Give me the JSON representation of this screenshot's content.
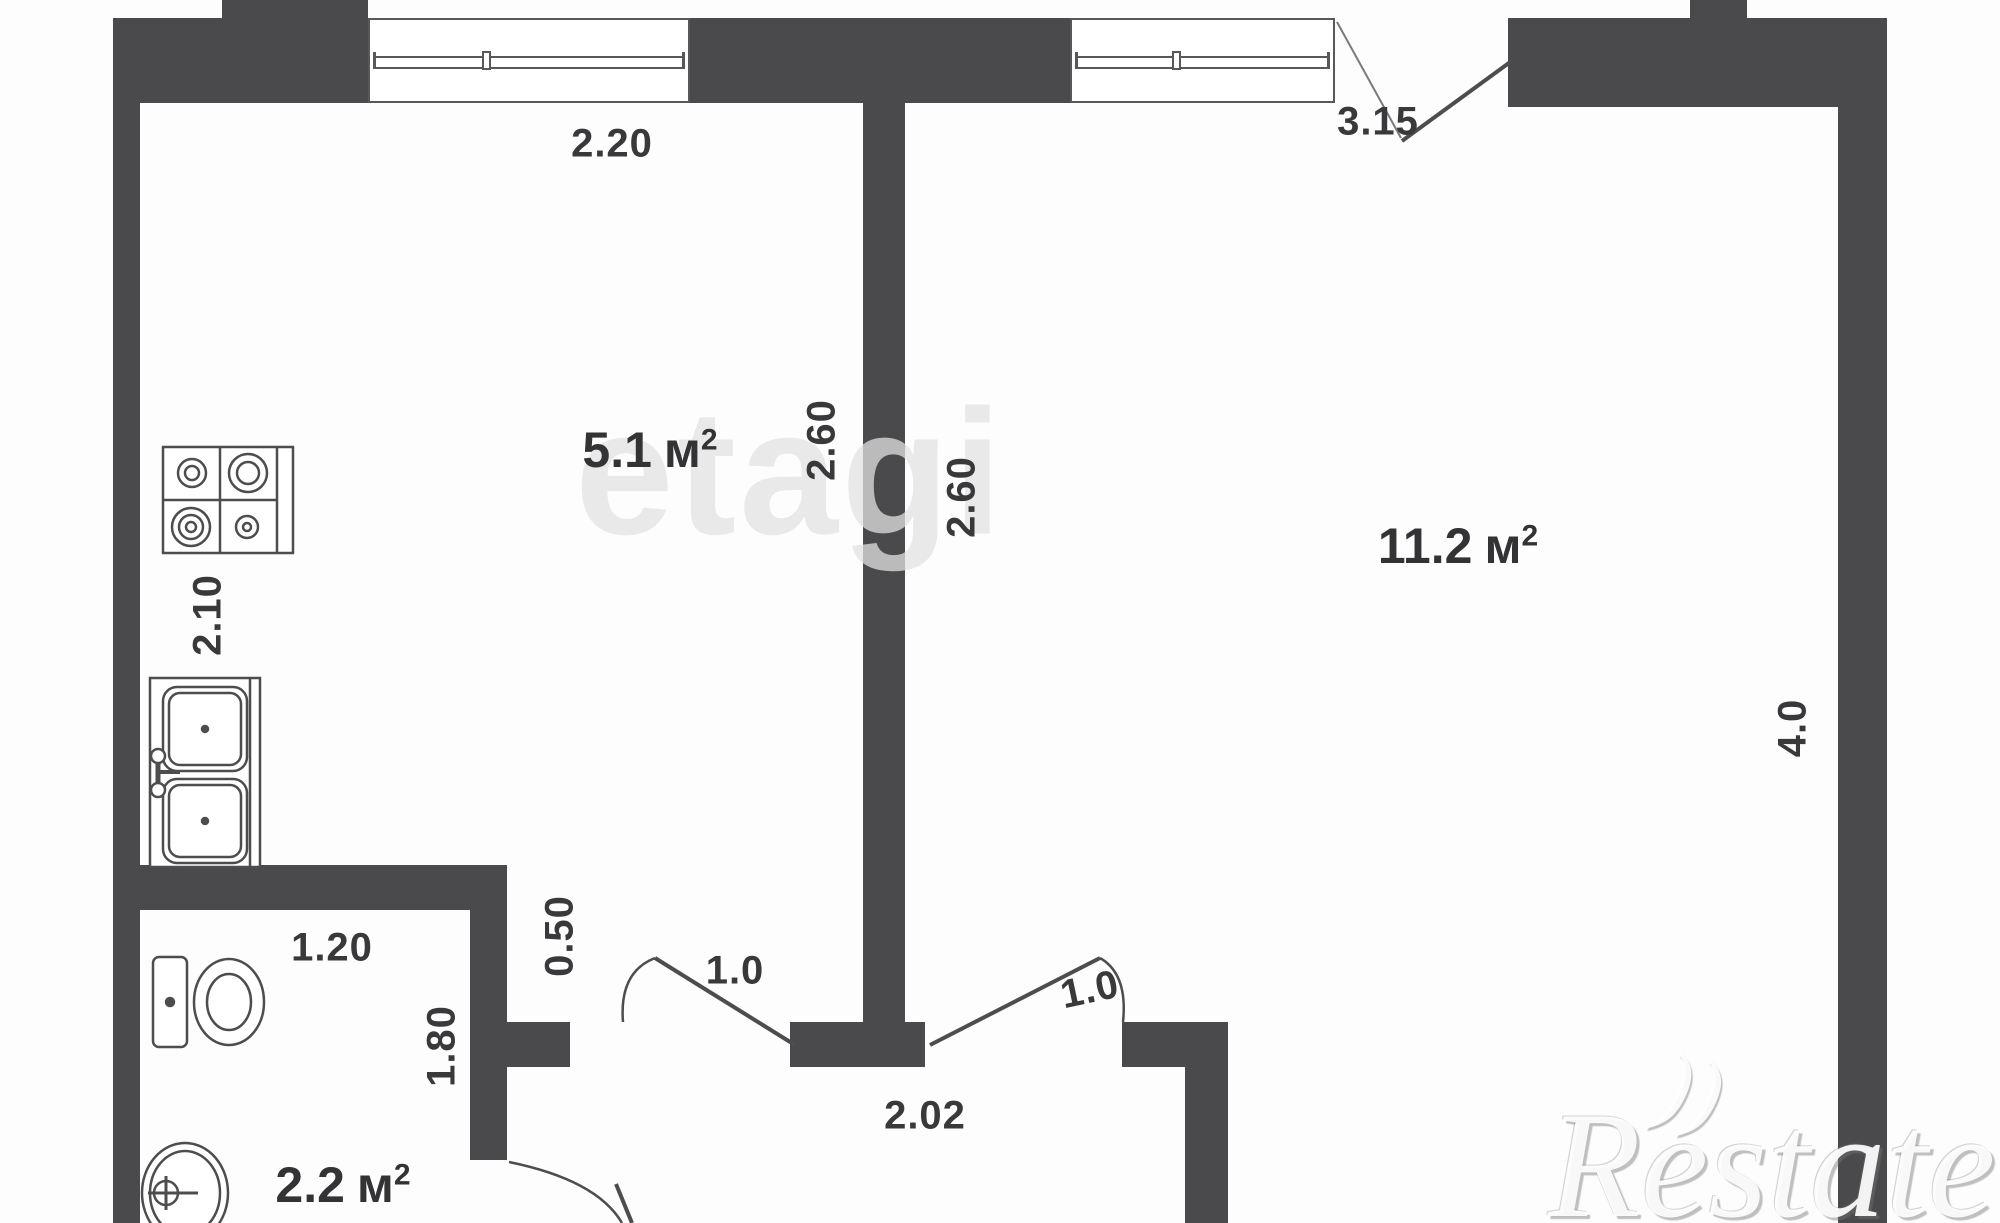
{
  "plan": {
    "watermark_center": "etagi",
    "watermark_corner": "Restate",
    "watermark_swoosh_glyph": "))",
    "colors": {
      "wall": "#4a4a4c",
      "text": "#39393b",
      "watermark": "#e2e2e2"
    },
    "rooms": [
      {
        "id": "kitchen",
        "area_value": "5.1",
        "area_unit": "м",
        "area_sup": "2"
      },
      {
        "id": "living-room",
        "area_value": "11.2",
        "area_unit": "м",
        "area_sup": "2"
      },
      {
        "id": "bathroom",
        "area_value": "2.2",
        "area_unit": "м",
        "area_sup": "2"
      }
    ],
    "dimensions": {
      "kitchen_window_width": "2.20",
      "room_window_wall": "3.15",
      "kitchen_inner_width": "2.60",
      "room_inner_width": "2.60",
      "room_right_depth": "4.0",
      "kitchen_left_depth": "2.10",
      "bathroom_width": "1.20",
      "bathroom_depth": "1.80",
      "kitchen_door_offset": "0.50",
      "kitchen_door_width": "1.0",
      "room_door_width": "1.0",
      "hallway_width": "2.02"
    },
    "icons": {
      "stove": "stove-icon",
      "kitchen_sink": "kitchen-sink-icon",
      "toilet": "toilet-icon",
      "washbasin": "washbasin-icon",
      "windows": "window-icon",
      "doors": "door-swing-icon"
    }
  }
}
